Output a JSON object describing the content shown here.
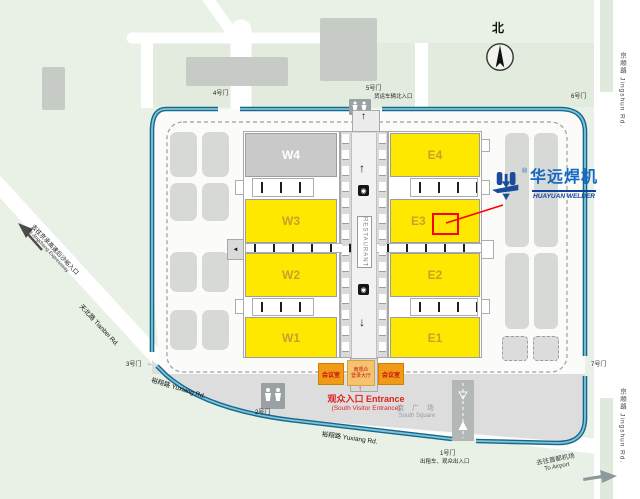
{
  "map": {
    "compass": {
      "north_label": "北"
    },
    "halls": {
      "w4": "W4",
      "w3": "W3",
      "w2": "W2",
      "w1": "W1",
      "e4": "E4",
      "e3": "E3",
      "e2": "E2",
      "e1": "E1"
    },
    "restaurant": "RESTAURANT",
    "gates": {
      "g1": "1号门",
      "g1_sub": "出租车、观众出入口",
      "g2": "2号门",
      "g3": "3号门",
      "g4": "4号门",
      "g5": "5号门",
      "g5_sub": "货运车辆北入口",
      "g6": "6号门",
      "g7": "7号门"
    },
    "roads": {
      "jingshun_top": "京顺路 Jingshun Rd.",
      "jingshun_bottom": "京顺路 Jingshun Rd.",
      "tianbei": "天北路  Tianbei Rd.",
      "yuxiang_left": "裕翔路 Yuxiang Rd.",
      "yuxiang_bottom": "裕翔路 Yuxiang Rd."
    },
    "directions": {
      "expressway_cn": "去往京承高速后沙峪入口",
      "expressway_en": "To Jingcheng Expressway",
      "airport_cn": "去往首都机场",
      "airport_en": "To Airport"
    },
    "entrance": {
      "arrow": "↑",
      "title": "观众入口 Entrance",
      "subtitle": "(South Visitor Entrance)",
      "meeting_left": "会议室",
      "meeting_right": "会议室",
      "reg_hall_line1": "南观众",
      "reg_hall_line2": "登录大厅"
    },
    "square": {
      "cn": "南 广 场",
      "en": "South Square"
    },
    "logo": {
      "reg": "®",
      "cn": "华远焊机",
      "en": "HUAYUAN WELDER"
    },
    "corridor": {
      "up": "↑",
      "down": "↓",
      "left": "◄",
      "facility": "◉"
    },
    "misc": {
      "gate3_arrow": "←"
    },
    "colors": {
      "hall_yellow": "#ffe800",
      "road_blue": "#15688b",
      "marker_red": "#ff0000",
      "logo_blue": "#1668c4",
      "orange": "#f09a18"
    }
  }
}
